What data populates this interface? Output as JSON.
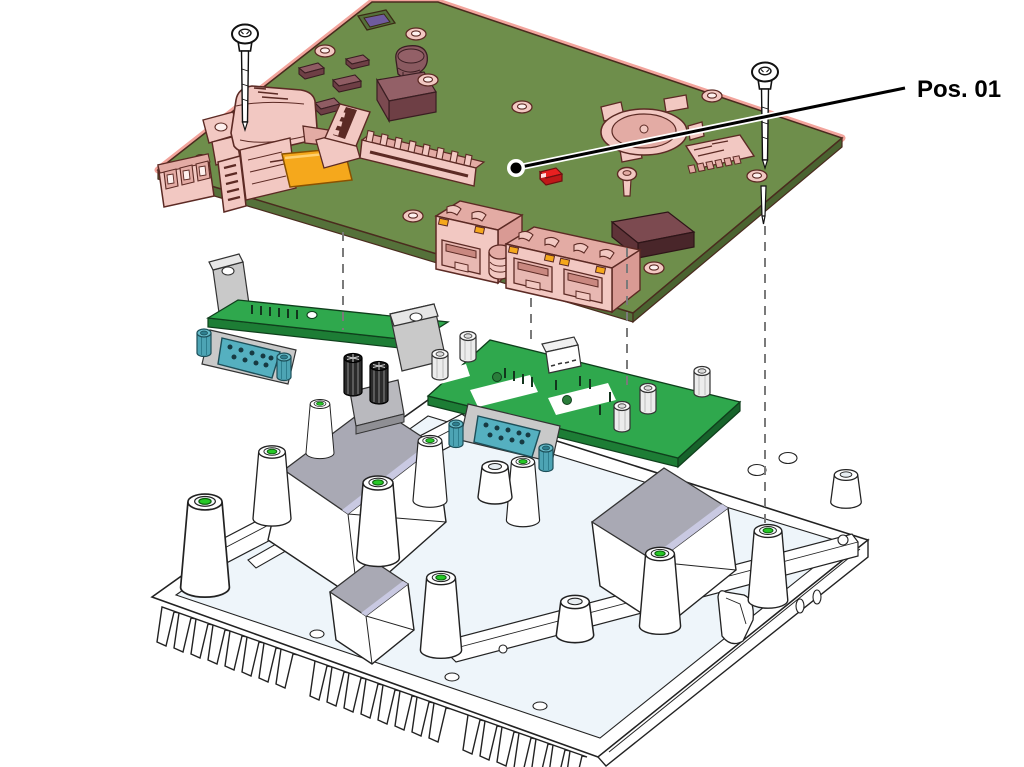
{
  "callout": {
    "label": "Pos. 01",
    "target_part": "main-board"
  },
  "parts": [
    {
      "id": "main-board",
      "name": "Main PCB assembly (highlighted position 01)"
    },
    {
      "id": "mounting-screw-left",
      "name": "Pan-head mounting screw"
    },
    {
      "id": "mounting-screw-right",
      "name": "Pan-head mounting screw"
    },
    {
      "id": "board-screw",
      "name": "Board fastening screw"
    },
    {
      "id": "power-connector",
      "name": "Power connector housing"
    },
    {
      "id": "terminal-block-connector",
      "name": "3-pole terminal block"
    },
    {
      "id": "usb-connector",
      "name": "USB connector stack"
    },
    {
      "id": "thermal-pad-orange",
      "name": "Thermal pad"
    },
    {
      "id": "pin-header-long",
      "name": "Multi-pin header"
    },
    {
      "id": "battery-holder",
      "name": "Coin-cell battery holder"
    },
    {
      "id": "microsd-slot",
      "name": "MicroSD card slot"
    },
    {
      "id": "status-led",
      "name": "Status LED"
    },
    {
      "id": "rj45-port-single",
      "name": "RJ45 Ethernet port"
    },
    {
      "id": "rj45-port-dual",
      "name": "Dual RJ45 Ethernet port"
    },
    {
      "id": "serial-board-left",
      "name": "Serial interface board with D-SUB 9 connector"
    },
    {
      "id": "serial-board-right",
      "name": "Serial interface board with D-SUB 9 connector"
    },
    {
      "id": "hex-standoffs",
      "name": "Hex spacer standoffs"
    },
    {
      "id": "heatsink-base",
      "name": "Finned heatsink base plate"
    },
    {
      "id": "thermal-pads-gray",
      "name": "Thermal interface pads"
    },
    {
      "id": "alignment-lines",
      "name": "Exploded-view alignment lines"
    }
  ],
  "colors": {
    "background": "#ffffff",
    "board_green": "#6e8e4b",
    "board_edge": "#55713a",
    "highlight_pink": "#f2c8c2",
    "highlight_shade": "#e3aba4",
    "highlight_outline": "#5c2a24",
    "halo_red": "#f2a49c",
    "chip_maroon": "#8f5c63",
    "chip_dark": "#6e3f45",
    "accent_orange": "#f5a81c",
    "led_red": "#e82020",
    "violet_socket": "#6f5b9e",
    "interface_board_green": "#2fa84d",
    "interface_board_edge": "#1d7d35",
    "dsub_teal": "#55b0c0",
    "metal_gray": "#c9c9c9",
    "standoff_white": "#ececec",
    "thermal_pad_gray": "#a9a9b4",
    "thermal_pad_violet": "#c9c9e2",
    "hole_green": "#26c826",
    "dash_gray": "#7a7a7a",
    "line_black": "#000000"
  }
}
